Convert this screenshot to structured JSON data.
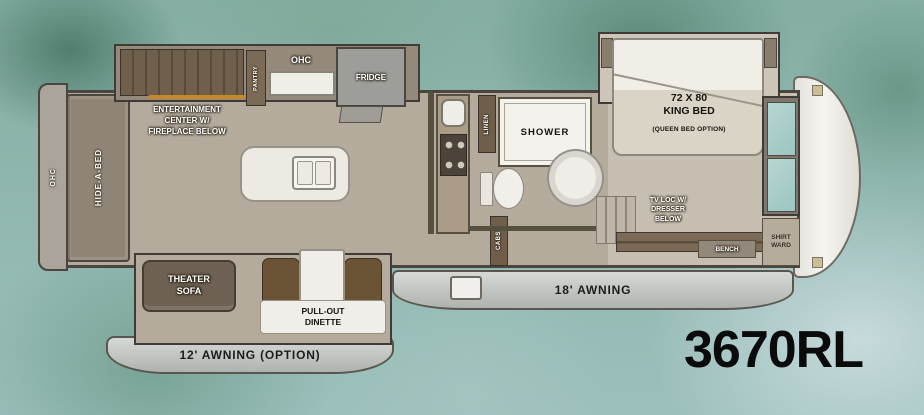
{
  "model_number": "3670RL",
  "labels": {
    "rear_ohc": "OHC",
    "hide_a_bed": "HIDE-A-BED",
    "entertainment_center": "ENTERTAINMENT\nCENTER W/\nFIREPLACE BELOW",
    "pantry": "PANTRY",
    "kitchen_ohc": "OHC",
    "fridge": "FRIDGE",
    "linen": "LINEN",
    "shower": "SHOWER",
    "king_bed": "72 X 80\nKING BED",
    "king_bed_option": "(QUEEN BED OPTION)",
    "dresser": "TV LOC W/\nDRESSER\nBELOW",
    "bench": "BENCH",
    "shirt_ward": "SHIRT\nWARD",
    "cabs": "CABS",
    "theater_sofa": "THEATER\nSOFA",
    "dinette": "PULL-OUT\nDINETTE",
    "awning_18": "18' AWNING",
    "awning_12": "12' AWNING (OPTION)"
  },
  "colors": {
    "background_teal": "#8fb5ad",
    "floor_tan": "#b4ab9d",
    "wood_brown": "#7b6a56",
    "model_text": "#0b0b0b"
  }
}
